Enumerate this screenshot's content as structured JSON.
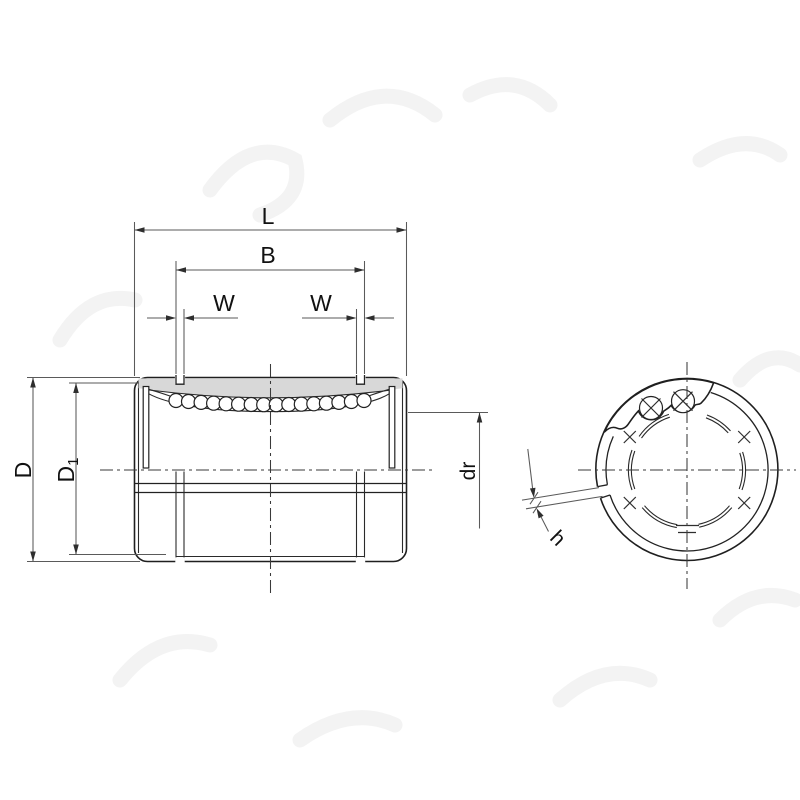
{
  "drawing": {
    "dimension_labels": {
      "length": "L",
      "inner_length": "B",
      "groove_width_left": "W",
      "groove_width_right": "W",
      "outer_diameter": "D",
      "inner_diameter_base": "D",
      "inner_diameter_subscript": "1",
      "shaft_diameter": "dr",
      "slit_width": "h"
    },
    "colors": {
      "outline": "#1f1f1f",
      "dimension_line": "#5a5a5a",
      "centerline": "#3a3a3a",
      "section_fill": "#d8d8d8",
      "ball_fill": "#ffffff",
      "background": "#ffffff",
      "watermark": "#f3f3f3"
    },
    "side_view": {
      "ball_count": 16
    },
    "end_view": {
      "visible_ball_count": 2,
      "track_mark_count": 4
    }
  }
}
